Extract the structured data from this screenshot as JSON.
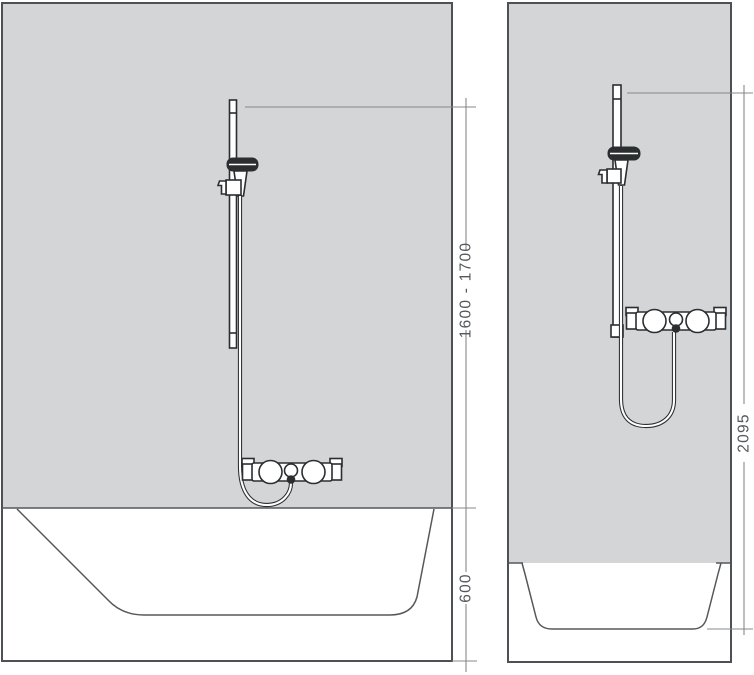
{
  "diagram": {
    "type": "shower-set-installation-drawing",
    "views": [
      {
        "name": "bathtub-installation",
        "dimensions": [
          {
            "label": "1600 - 1700",
            "orientation": "vertical"
          },
          {
            "label": "600",
            "orientation": "vertical"
          }
        ]
      },
      {
        "name": "shower-tray-installation",
        "dimensions": [
          {
            "label": "2095",
            "orientation": "vertical"
          }
        ]
      }
    ]
  },
  "colors": {
    "background": "#ffffff",
    "wall": "#d4d5d7",
    "outline": "#4d5156",
    "profile": "#55585c",
    "fixture": "#2b2e31",
    "dimension": "#85888c",
    "dimText": "#54575b"
  }
}
